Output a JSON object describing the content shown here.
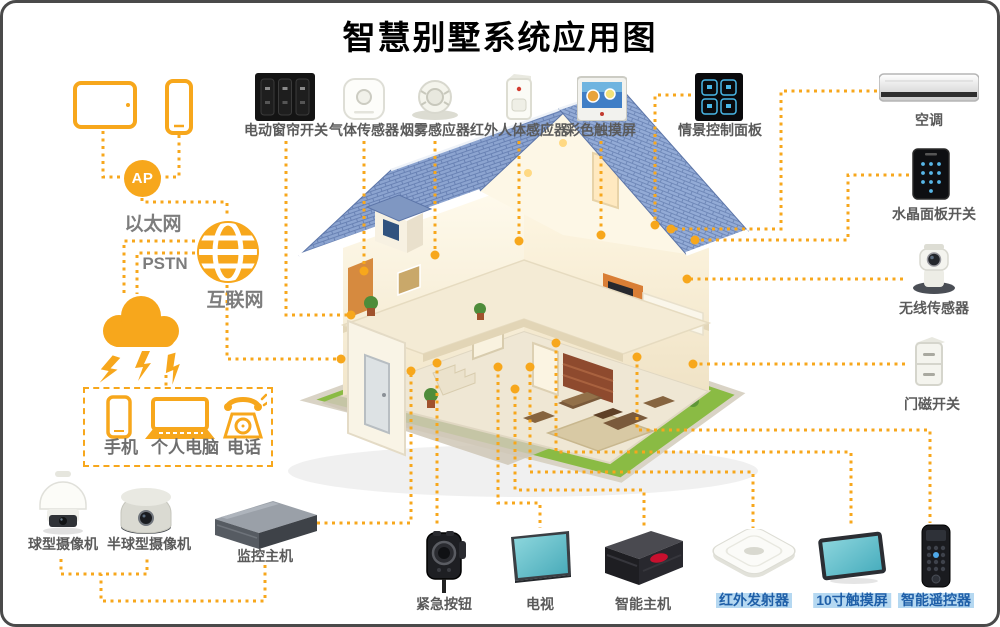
{
  "title": "智慧别墅系统应用图",
  "network": {
    "ap": "AP",
    "ethernet": "以太网",
    "pstn": "PSTN",
    "internet": "互联网"
  },
  "top_devices": [
    {
      "id": "curtain-switch",
      "label": "电动窗帘开关"
    },
    {
      "id": "gas-sensor",
      "label": "气体传感器"
    },
    {
      "id": "smoke-sensor",
      "label": "烟雾感应器"
    },
    {
      "id": "pir-sensor",
      "label": "红外人体感应器"
    },
    {
      "id": "color-touchscreen",
      "label": "彩色触摸屏"
    },
    {
      "id": "scene-control-panel",
      "label": "情景控制面板"
    }
  ],
  "right_devices": [
    {
      "id": "air-conditioner",
      "label": "空调"
    },
    {
      "id": "crystal-panel-switch",
      "label": "水晶面板开关"
    },
    {
      "id": "wireless-sensor",
      "label": "无线传感器"
    },
    {
      "id": "door-magnet-switch",
      "label": "门磁开关"
    }
  ],
  "client_devices": [
    {
      "id": "mobile-phone",
      "label": "手机"
    },
    {
      "id": "personal-computer",
      "label": "个人电脑"
    },
    {
      "id": "telephone",
      "label": "电话"
    }
  ],
  "surveillance_devices": [
    {
      "id": "ptz-dome-camera",
      "label": "球型摄像机"
    },
    {
      "id": "mini-dome-camera",
      "label": "半球型摄像机"
    },
    {
      "id": "surveillance-host",
      "label": "监控主机"
    }
  ],
  "bottom_devices": [
    {
      "id": "emergency-button",
      "label": "紧急按钮",
      "highlighted": false
    },
    {
      "id": "tv",
      "label": "电视",
      "highlighted": false
    },
    {
      "id": "smart-host",
      "label": "智能主机",
      "highlighted": false
    },
    {
      "id": "ir-transmitter",
      "label": "红外发射器",
      "highlighted": true
    },
    {
      "id": "touchscreen-10inch",
      "label": "10寸触摸屏",
      "highlighted": true
    },
    {
      "id": "smart-remote",
      "label": "智能遥控器",
      "highlighted": true
    }
  ],
  "colors": {
    "accent_orange": "#F7A71C",
    "label_gray": "#5A5A5A",
    "network_gray": "#7D7D7D",
    "highlight_text_blue": "#1F5FA8",
    "highlight_bg_blue": "#B5D8F1",
    "roof_blue": "#8CA4D0",
    "lawn_green": "#8ABB44"
  }
}
